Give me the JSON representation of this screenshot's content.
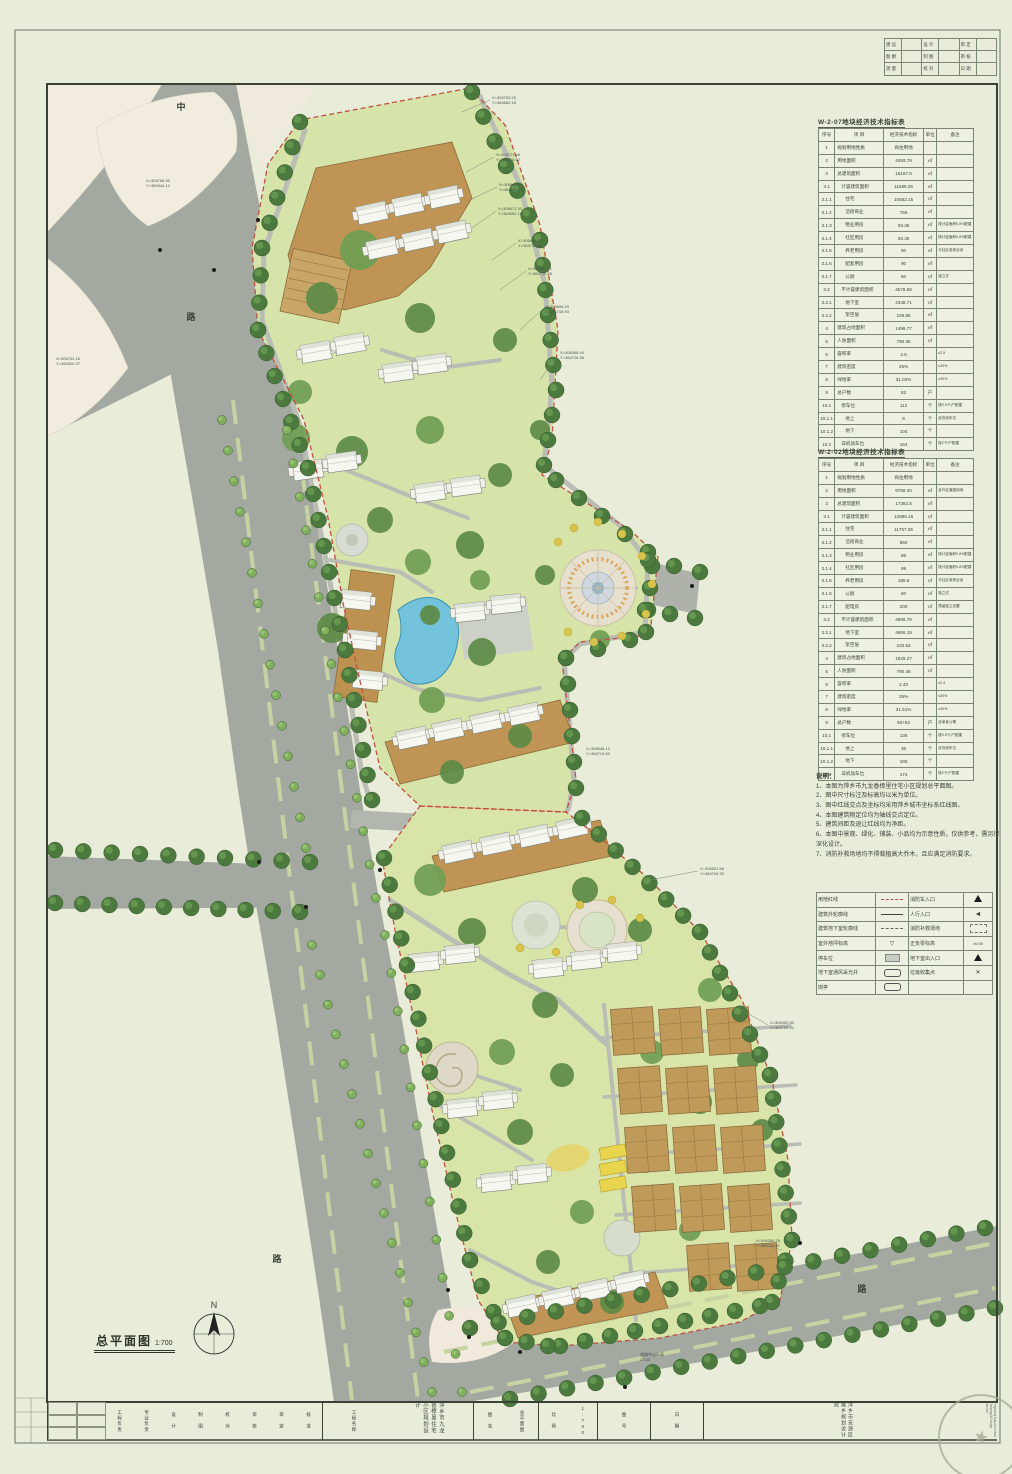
{
  "sheet": {
    "drawing_label": "总平面图",
    "scale": "1:700",
    "north_letter": "N"
  },
  "colors": {
    "paper": "#e9ecd9",
    "site_green": "#d6e3a9",
    "road_gray": "#a3a8a1",
    "podium_brown": "#bf9454",
    "pool_blue": "#74c3dc",
    "boundary_red": "#c05044",
    "tree_dark": "#4c7a3e",
    "tree_light": "#7fae5c",
    "plaza_tan": "#e7e0ce",
    "parking_yellow": "#e8d44d"
  },
  "corner_table": {
    "rows": [
      [
        "建 设",
        "设 计",
        "审 定"
      ],
      [
        "勘 察",
        "制 图",
        "审 核"
      ],
      [
        "测 量",
        "校 对",
        "日 期"
      ]
    ]
  },
  "table1": {
    "title": "W-2-07地块经济技术指标表",
    "headers": [
      "序号",
      "项  目",
      "经济技术指标",
      "单位",
      "备注"
    ],
    "rows": [
      [
        "1",
        "规划用地性质",
        "商住用地",
        "",
        ""
      ],
      [
        "2",
        "用地面积",
        "4493.79",
        "㎡",
        ""
      ],
      [
        "3",
        "总建筑面积",
        "16167.8",
        "㎡",
        ""
      ],
      [
        "3.1",
        "计容建筑面积",
        "11589.26",
        "㎡",
        ""
      ],
      [
        "3.1.1",
        "住宅",
        "10662.15",
        "㎡",
        ""
      ],
      [
        "3.1.2",
        "沿街商业",
        "756",
        "㎡",
        ""
      ],
      [
        "3.1.3",
        "物业用房",
        "93.35",
        "㎡",
        "按计容面积0.8%配建"
      ],
      [
        "3.1.4",
        "社区用房",
        "93.35",
        "㎡",
        "按计容面积0.8%配建"
      ],
      [
        "3.1.5",
        "养老用房",
        "90",
        "㎡",
        "与社区用房合设"
      ],
      [
        "3.1.6",
        "配套用房",
        "90",
        "㎡",
        ""
      ],
      [
        "3.1.7",
        "公厕",
        "60",
        "㎡",
        "独立式"
      ],
      [
        "3.2",
        "不计容建筑面积",
        "4578.56",
        "㎡",
        ""
      ],
      [
        "3.2.1",
        "地下室",
        "4348.71",
        "㎡",
        ""
      ],
      [
        "3.2.2",
        "架空层",
        "229.85",
        "㎡",
        ""
      ],
      [
        "4",
        "建筑占地面积",
        "1496.77",
        "㎡",
        ""
      ],
      [
        "5",
        "人防面积",
        "790.36",
        "㎡",
        ""
      ],
      [
        "6",
        "容积率",
        "2.5",
        "",
        "≤2.5"
      ],
      [
        "7",
        "建筑密度",
        "25%",
        "",
        "≤30%"
      ],
      [
        "8",
        "绿地率",
        "31.02%",
        "",
        "≥30%"
      ],
      [
        "9",
        "总户数",
        "82",
        "户",
        ""
      ],
      [
        "10.1",
        "停车位",
        "112",
        "个",
        "按0.9个/户配建"
      ],
      [
        "10.1.1",
        "地上",
        "8",
        "个",
        "含充电车位"
      ],
      [
        "10.1.2",
        "地下",
        "104",
        "个",
        ""
      ],
      [
        "10.2",
        "非机动车位",
        "164",
        "个",
        "按2个/户配建"
      ]
    ]
  },
  "table2": {
    "title": "W-2-02地块经济技术指标表",
    "headers": [
      "序号",
      "项  目",
      "经济技术指标",
      "单位",
      "备注"
    ],
    "rows": [
      [
        "1",
        "规划用地性质",
        "商住用地",
        "",
        ""
      ],
      [
        "2",
        "用地面积",
        "9759.40",
        "㎡",
        "含代征道路用地"
      ],
      [
        "3",
        "总建筑面积",
        "17382.5",
        "㎡",
        ""
      ],
      [
        "3.1",
        "计容建筑面积",
        "12896.16",
        "㎡",
        ""
      ],
      [
        "3.1.1",
        "住宅",
        "11757.06",
        "㎡",
        ""
      ],
      [
        "3.1.2",
        "沿街商业",
        "850",
        "㎡",
        ""
      ],
      [
        "3.1.3",
        "物业用房",
        "98",
        "㎡",
        "按计容面积0.8%配建"
      ],
      [
        "3.1.4",
        "社区用房",
        "99",
        "㎡",
        "按计容面积0.8%配建"
      ],
      [
        "3.1.5",
        "养老用房",
        "196.6",
        "㎡",
        "与社区用房合设"
      ],
      [
        "3.1.6",
        "公厕",
        "60",
        "㎡",
        "独立式"
      ],
      [
        "3.1.7",
        "配电房",
        "200",
        "㎡",
        "预留独立设置"
      ],
      [
        "3.2",
        "不计容建筑面积",
        "4886.79",
        "㎡",
        ""
      ],
      [
        "3.2.1",
        "地下室",
        "4666.19",
        "㎡",
        ""
      ],
      [
        "3.2.2",
        "架空层",
        "220.64",
        "㎡",
        ""
      ],
      [
        "4",
        "建筑占地面积",
        "1929.27",
        "㎡",
        ""
      ],
      [
        "5",
        "人防面积",
        "790.46",
        "㎡",
        ""
      ],
      [
        "6",
        "容积率",
        "2.40",
        "",
        "≤2.4"
      ],
      [
        "7",
        "建筑密度",
        "25%",
        "",
        "≤30%"
      ],
      [
        "8",
        "绿地率",
        "31.51%",
        "",
        "≥30%"
      ],
      [
        "9",
        "总户数",
        "93+62",
        "户",
        "含单身公寓"
      ],
      [
        "10.1",
        "停车位",
        "136",
        "个",
        "按0.9个/户配建"
      ],
      [
        "10.1.1",
        "地上",
        "36",
        "个",
        "含充电车位"
      ],
      [
        "10.1.2",
        "地下",
        "100",
        "个",
        ""
      ],
      [
        "10.2",
        "非机动车位",
        "174",
        "个",
        "按2个/户配建"
      ]
    ]
  },
  "notes": {
    "title": "说明：",
    "items": [
      "1、本图为萍乡市九龙香樟里住宅小区规划总平面图。",
      "2、图中尺寸标注及标高均以米为单位。",
      "3、图中红线交点及坐标均采用萍乡城市坐标系红线图。",
      "4、本图建筑物定位均为轴线交点定位。",
      "5、建筑间距及退让红线均为净距。",
      "6、本图中景观、绿化、铺装、小品均为示意性质，仅供参考，需另行深化设计。",
      "7、消防补救场地均不得栽植高大乔木，且应满足消防要求。"
    ]
  },
  "legend": {
    "rows": [
      {
        "l": "用地红线",
        "ls": "red-dash",
        "r": "消防车入口",
        "rs": "tri"
      },
      {
        "l": "建筑外轮廓线",
        "ls": "solid",
        "r": "人行入口",
        "rs": "arrow"
      },
      {
        "l": "建筑地下室轮廓线",
        "ls": "dashdot",
        "r": "消防补救场地",
        "rs": "dashed-box"
      },
      {
        "l": "室外地坪标高",
        "ls": "level",
        "r": "正负零标高",
        "rs": "level2"
      },
      {
        "l": "停车位",
        "ls": "parking",
        "r": "地下室出入口",
        "rs": "tri"
      },
      {
        "l": "地下室通风采光井",
        "ls": "roundbox",
        "r": "垃圾收集点",
        "rs": "x"
      },
      {
        "l": "岗亭",
        "ls": "roundbox",
        "r": "",
        "rs": ""
      }
    ]
  },
  "titleblock": {
    "sign_labels": [
      "工程负责",
      "专业负责",
      "设 计",
      "制 图",
      "校 对",
      "审 核",
      "审 定",
      "核 准"
    ],
    "project_label": "工程名称",
    "project_name": "萍乡市九龙香樟里住宅小区规划设计",
    "sheet_label": "图 名",
    "sheet_name": "总平面图",
    "scale_label": "比 例",
    "scale_value": "1:700",
    "no_label": "图 号",
    "date_label": "日 期",
    "institute_cn": "萍乡市安源区城乡规划设计院",
    "institute_en": "Pingxiang Anyuan Urban Planning & Design Institute",
    "seal_icon": "★"
  },
  "plan": {
    "road_labels": [
      {
        "x": 181,
        "y": 110,
        "t": "中"
      },
      {
        "x": 191,
        "y": 320,
        "t": "路"
      },
      {
        "x": 277,
        "y": 1262,
        "t": "路"
      },
      {
        "x": 862,
        "y": 1292,
        "t": "路"
      }
    ],
    "annotations": [
      {
        "x": 492,
        "y": 95,
        "t": "X=306753.25\nY=384662.18"
      },
      {
        "x": 496,
        "y": 152,
        "t": "X=306721.48\nY=384678.62"
      },
      {
        "x": 499,
        "y": 182,
        "t": "X=306695.10\nY=384684.27"
      },
      {
        "x": 498,
        "y": 206,
        "t": "X=306672.33\nY=384690.15"
      },
      {
        "x": 518,
        "y": 238,
        "t": "X=306648.52\nY=384702.84"
      },
      {
        "x": 528,
        "y": 266,
        "t": "X=306624.71\nY=384710.46"
      },
      {
        "x": 545,
        "y": 304,
        "t": "X=306596.20\nY=384718.93"
      },
      {
        "x": 560,
        "y": 350,
        "t": "X=306568.44\nY=384726.58"
      },
      {
        "x": 56,
        "y": 356,
        "t": "X=306702.16\nY=384520.37"
      },
      {
        "x": 146,
        "y": 178,
        "t": "X=306768.90\nY=384544.12"
      },
      {
        "x": 700,
        "y": 866,
        "t": "X=306521.66\nY=384709.33"
      },
      {
        "x": 770,
        "y": 1020,
        "t": "X=306452.80\nY=384752.41"
      },
      {
        "x": 756,
        "y": 1238,
        "t": "X=306380.25\nY=384760.87"
      },
      {
        "x": 640,
        "y": 1352,
        "t": "道路中心标高\n23.50"
      },
      {
        "x": 586,
        "y": 746,
        "t": "X=306548.12\nY=384714.60"
      }
    ]
  }
}
